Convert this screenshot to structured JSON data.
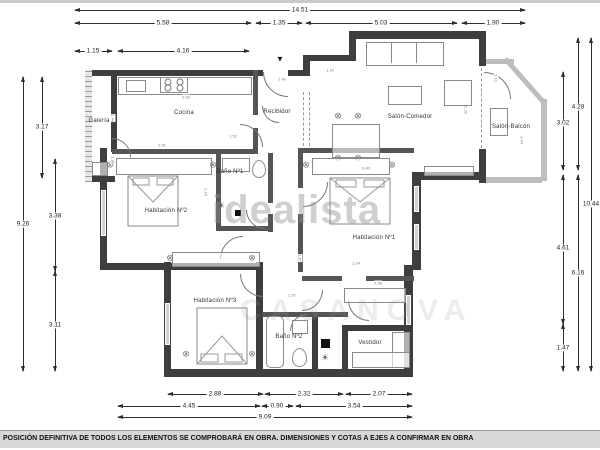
{
  "plan": {
    "rooms": {
      "galeria": {
        "label": "Galería"
      },
      "cocina": {
        "label": "Cocina"
      },
      "recibidor": {
        "label": "Recibidor"
      },
      "salon_comedor": {
        "label": "Salón-Comedor"
      },
      "salon_balcon": {
        "label": "Salón-Balcón"
      },
      "bano1": {
        "label": "Baño Nº1"
      },
      "hab2": {
        "label": "Habitación Nº2"
      },
      "hab1": {
        "label": "Habitación Nº1"
      },
      "hab3": {
        "label": "Habitación Nº3"
      },
      "bano2": {
        "label": "Baño Nº2"
      },
      "vestidor": {
        "label": "Vestidor"
      }
    },
    "icons": {
      "chair": "⊗",
      "radiator": "☀",
      "entrance": "▼"
    }
  },
  "dims": {
    "top": [
      {
        "v": "14.51"
      },
      {
        "v": "5.58"
      },
      {
        "v": "1.35"
      },
      {
        "v": "5.03"
      },
      {
        "v": "1.90"
      },
      {
        "v": "1.15"
      },
      {
        "v": "4.16"
      }
    ],
    "left": [
      {
        "v": "9.26"
      },
      {
        "v": "3.17"
      },
      {
        "v": "3.38"
      },
      {
        "v": "3.11"
      }
    ],
    "right": [
      {
        "v": "4.28"
      },
      {
        "v": "3.02"
      },
      {
        "v": "10.44"
      },
      {
        "v": "4.61"
      },
      {
        "v": "6.16"
      },
      {
        "v": "1.47"
      }
    ],
    "bottom": [
      {
        "v": "2.88"
      },
      {
        "v": "2.32"
      },
      {
        "v": "2.07"
      },
      {
        "v": "4.45"
      },
      {
        "v": "0.90"
      },
      {
        "v": "3.54"
      },
      {
        "v": "9.09"
      }
    ],
    "tiny": [
      {
        "v": "1.44"
      },
      {
        "v": "1.98"
      },
      {
        "v": "3.53"
      },
      {
        "v": "2.91"
      },
      {
        "v": "1.40"
      },
      {
        "v": "1.52"
      },
      {
        "v": "1.10"
      },
      {
        "v": "1.13"
      },
      {
        "v": "2.33"
      },
      {
        "v": "3.40"
      },
      {
        "v": "2.15"
      },
      {
        "v": "1.24"
      },
      {
        "v": "2.96"
      },
      {
        "v": "1.87"
      },
      {
        "v": "1.44"
      },
      {
        "v": "1.57"
      }
    ]
  },
  "watermarks": {
    "primary": "idealista",
    "secondary": "CASANOVA"
  },
  "footer": {
    "text": "POSICIÓN DEFINITIVA DE TODOS LOS ELEMENTOS SE COMPROBARÁ EN OBRA. DIMENSIONES Y COTAS A EJES A CONFIRMAR EN OBRA"
  },
  "colors": {
    "wall": "#3e3e3e",
    "glazing": "#bdbdbd",
    "footer_bg": "#d7d7d7"
  }
}
